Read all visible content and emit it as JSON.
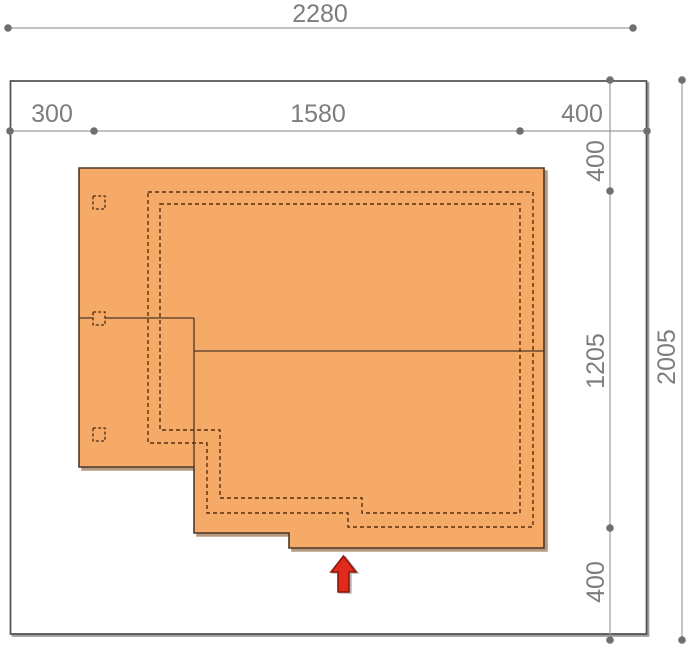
{
  "colors": {
    "building_fill": "#f6aa68",
    "building_outline": "#4a3828",
    "roof_dash": "#59300e",
    "dimension_line": "#9c9c9c",
    "dimension_text": "#7d7d7d",
    "plot_border": "#4f4f4f",
    "arrow_fill": "#e02a1c",
    "arrow_outline": "#8e150b"
  },
  "dimensions": {
    "total_width": "2280",
    "left_offset": "300",
    "building_width": "1580",
    "right_offset": "400",
    "top_offset": "400",
    "building_depth": "1205",
    "bottom_offset": "400",
    "total_depth": "2005"
  }
}
